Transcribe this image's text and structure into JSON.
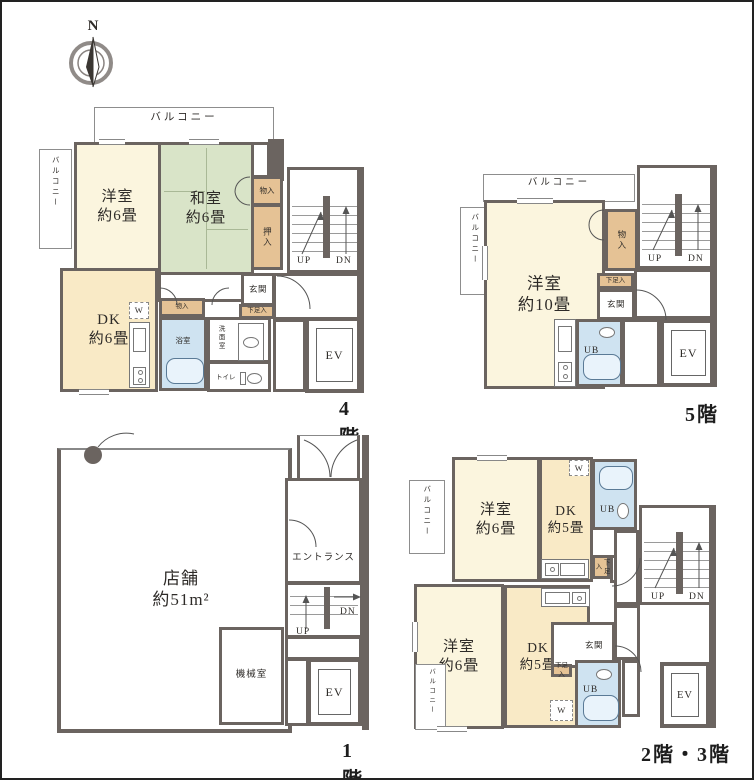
{
  "colors": {
    "wall": "#6b6460",
    "western_room": "#fbf5de",
    "tatami_room": "#d9e4c8",
    "dining_kitchen": "#f9eac6",
    "closet": "#e5c295",
    "bathroom": "#cfe3f1",
    "text": "#2e2b28"
  },
  "compass": {
    "north": "N"
  },
  "labels": {
    "balcony": "バルコニー",
    "up": "UP",
    "dn": "DN",
    "ev": "EV",
    "genkan": "玄関",
    "shoe": "下足入",
    "storage": "物入",
    "oshiire": "押入",
    "washer": "W",
    "ub": "UB",
    "bath": "浴室",
    "washroom": "洗面室",
    "toilet": "トイレ"
  },
  "floors": {
    "f4": {
      "name": "4階",
      "western": "洋室\n約6畳",
      "japanese": "和室\n約6畳",
      "dk": "DK\n約6畳"
    },
    "f5": {
      "name": "5階",
      "western": "洋室\n約10畳"
    },
    "f1": {
      "name": "1階",
      "shop": "店舗\n約51m²",
      "entrance": "エントランス",
      "machine_room": "機械室"
    },
    "f23": {
      "name": "2階・3階",
      "western_a": "洋室\n約6畳",
      "dk_a": "DK\n約5畳",
      "western_b": "洋室\n約6畳",
      "dk_b": "DK\n約5畳"
    }
  }
}
